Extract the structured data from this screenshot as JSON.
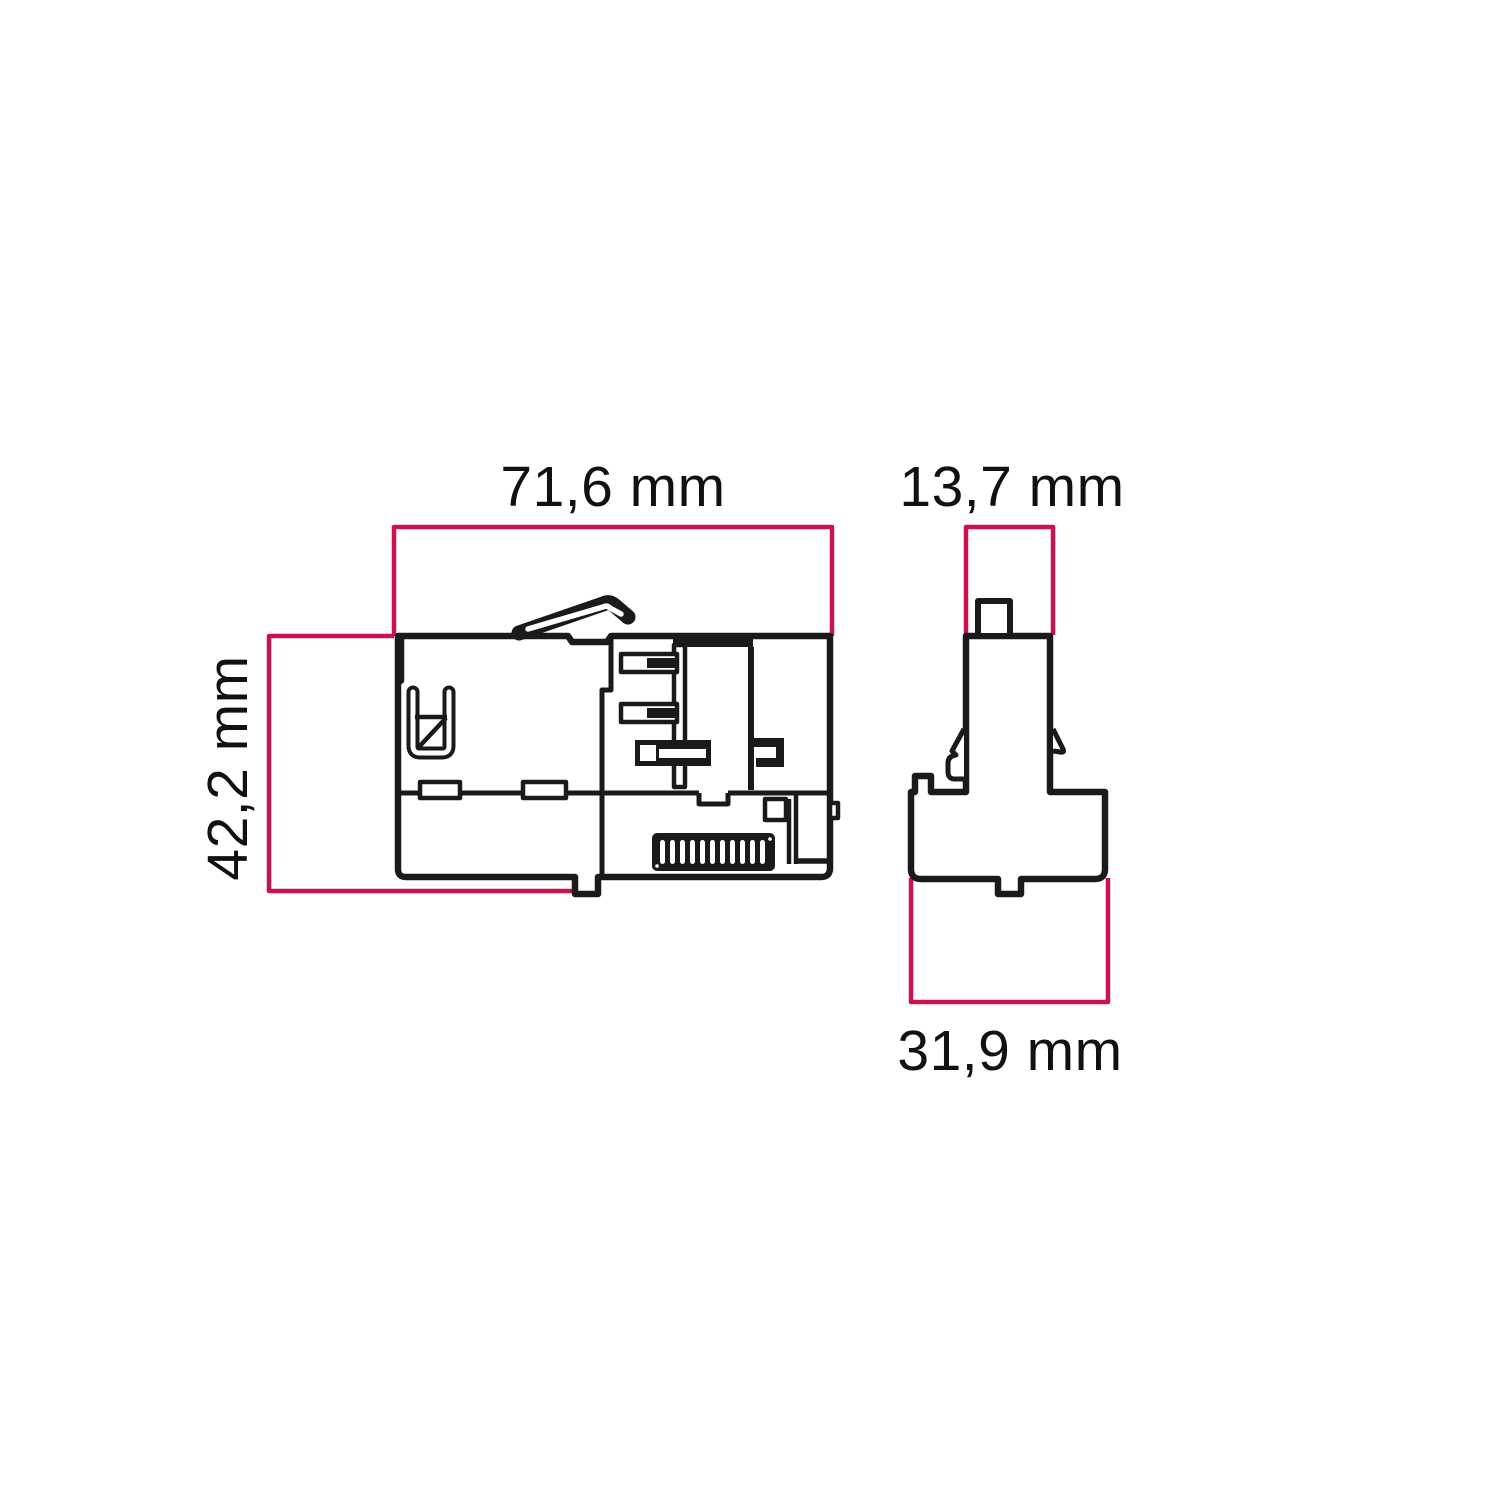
{
  "diagram": {
    "subject": "track-adapter-dimension-drawing",
    "background_color": "#ffffff",
    "outline_color": "#1a1a1a",
    "dimension_color": "#c9134c",
    "views": {
      "side": {
        "name": "side-view",
        "width_label": "71,6 mm",
        "height_label": "42,2 mm"
      },
      "front": {
        "name": "front-view",
        "top_width_label": "13,7 mm",
        "bottom_width_label": "31,9 mm"
      }
    }
  }
}
